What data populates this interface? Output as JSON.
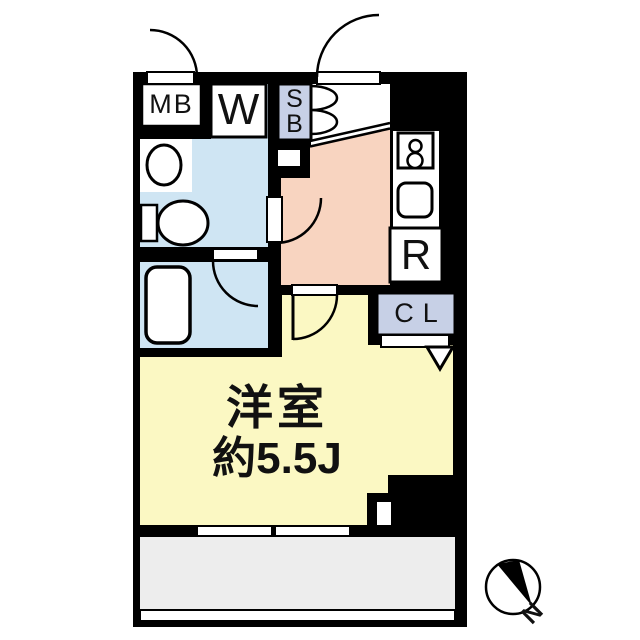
{
  "plan": {
    "title": "1K apartment floor plan",
    "labels": {
      "meter_box": "MB",
      "washer": "W",
      "shoe_box_line1": "S",
      "shoe_box_line2": "B",
      "refrigerator": "R",
      "closet": "CL",
      "room_name": "洋室",
      "room_size": "約5.5J",
      "compass_north": "N"
    },
    "colors": {
      "wall": "#000000",
      "washroom": "#cfe5f3",
      "bathroom": "#cfe5f3",
      "kitchen": "#f8d4c0",
      "room": "#fbf8c3",
      "closet_fill": "#c7d0e6",
      "shoebox_fill": "#c7d0e6",
      "balcony": "#ededed",
      "fixture": "#ffffff"
    }
  }
}
